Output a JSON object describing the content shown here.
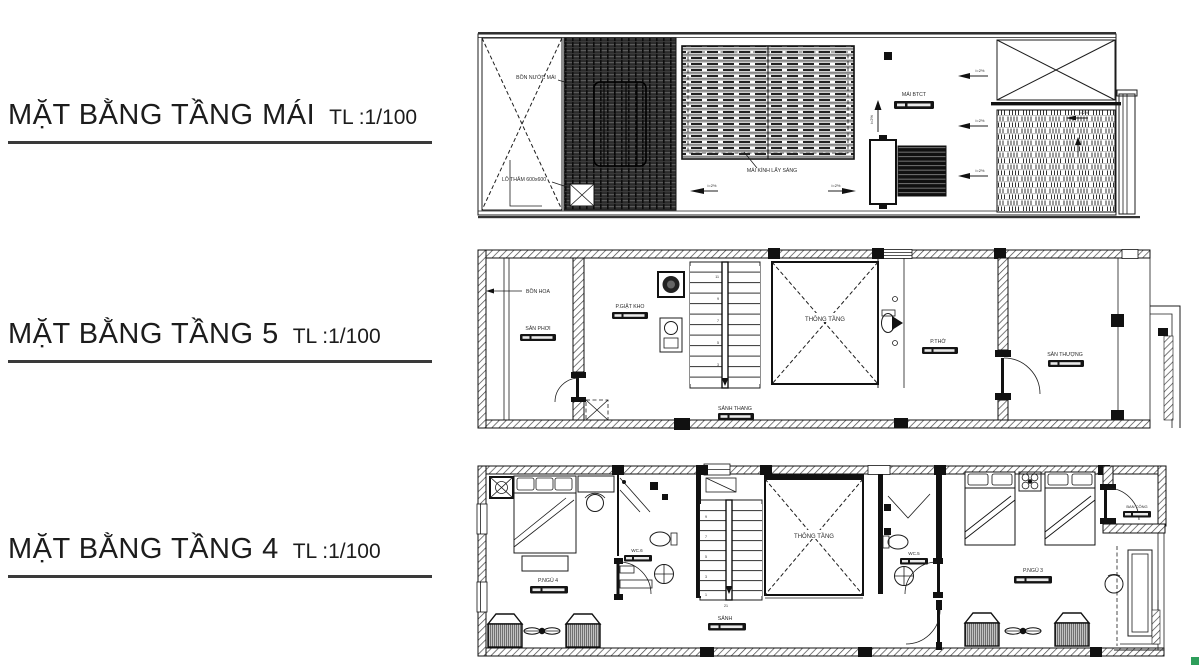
{
  "titles": [
    {
      "label": "MẶT BẰNG TẦNG MÁI",
      "scale": "TL :1/100"
    },
    {
      "label": "MẶT BẰNG TẦNG 5",
      "scale": "TL :1/100"
    },
    {
      "label": "MẶT BẰNG TẦNG 4",
      "scale": "TL :1/100"
    }
  ],
  "roof": {
    "water_tank": "BỒN NƯỚC MÁI",
    "inspection_hole": "LỖ THĂM 600x600",
    "skylight": "MÁI KÍNH LẤY SÁNG",
    "concrete_roof": "MÁI BTCT",
    "slope": "i=2%"
  },
  "floor5": {
    "flower_box": "BỒN HOA",
    "drying_yard": "SÂN PHƠI",
    "laundry": "P.GIẶT KHO",
    "void": "THÔNG TẦNG",
    "worship_room": "P.THỜ",
    "terrace": "SÂN THƯỢNG",
    "stair_hall": "SẢNH THANG",
    "stair_numbers": [
      "3",
      "5",
      "7",
      "9",
      "11"
    ]
  },
  "floor4": {
    "bedroom_4": "P.NGỦ 4",
    "wc_6": "WC.6",
    "hall": "SẢNH",
    "void": "THÔNG TẦNG",
    "wc_5": "WC.5",
    "bedroom_3": "P.NGỦ 3",
    "balcony": "BAN CÔNG",
    "stair_numbers": [
      "1",
      "3",
      "5",
      "7",
      "9"
    ],
    "stair_total": "21"
  }
}
